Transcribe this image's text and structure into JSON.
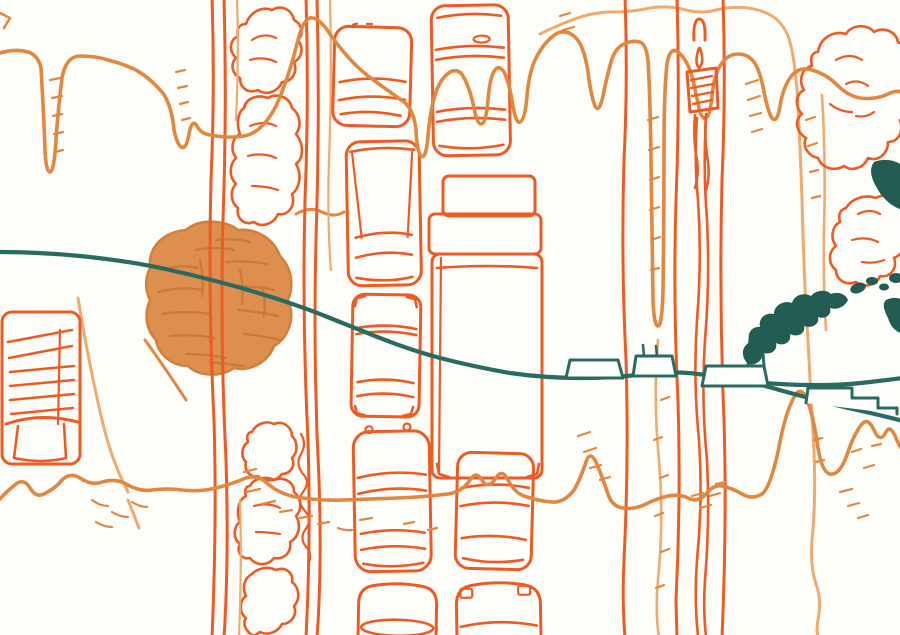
{
  "artwork": {
    "description": "Hand-drawn felt-tip marker sketch: top-down view of a traffic queue on a tree-lined boulevard, crossed by a teal horizon line with small factory buildings and a billowing smoke plume; dripping contour lines span the page.",
    "canvas": {
      "width": 900,
      "height": 635
    },
    "palette": {
      "paper": "#fdfdfa",
      "orange_bright": "#ef5a22",
      "orange_mid": "#e2873f",
      "orange_light": "#f0aa6e",
      "blob_fill": "#dd8f4f",
      "blob_texture": "#c9752f",
      "blob_outline": "#d4803a",
      "teal": "#2a6b60",
      "teal_dark": "#225c52"
    },
    "elements": [
      "drip-contour-lines",
      "boulevard-road-lines",
      "median-tree-scribbles",
      "painted-canopy-blob",
      "parked-truck",
      "traffic-queue-cars",
      "semi-truck",
      "hatched-road-sign",
      "big-scribble-tree",
      "teal-horizon-line",
      "factory-buildings",
      "factory-chimney",
      "smoke-plume",
      "stepped-building",
      "hatch-marks",
      "speckle-dots"
    ]
  }
}
